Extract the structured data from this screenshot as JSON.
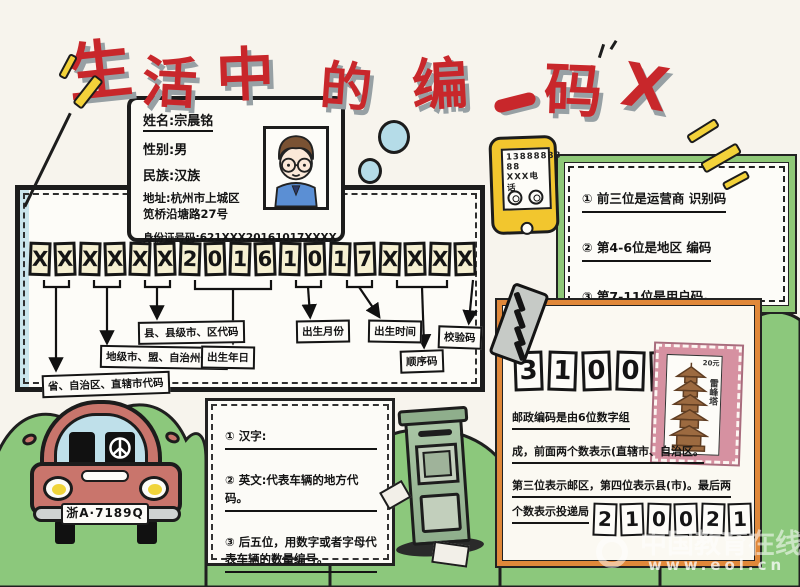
{
  "title": {
    "chars": [
      "生",
      "活",
      "中",
      "的",
      "编",
      "码"
    ],
    "cross": "X"
  },
  "id_card": {
    "name": "姓名:宗晨铭",
    "gender": "性别:男",
    "ethnic": "民族:汉族",
    "address1": "地址:杭州市上城区",
    "address2": "笕桥沿塘路27号",
    "id_number": "身份证号码:621XXX20161017XXXX"
  },
  "id_panel": {
    "digits": [
      "X",
      "X",
      "X",
      "X",
      "X",
      "X",
      "2",
      "0",
      "1",
      "6",
      "1",
      "0",
      "1",
      "7",
      "X",
      "X",
      "X",
      "X"
    ],
    "labels": [
      "省、自治区、直辖市代码",
      "地级市、盟、自治州代码",
      "县、县级市、区代码",
      "出生年日",
      "出生月份",
      "出生时间",
      "顺序码",
      "校验码"
    ]
  },
  "phone": {
    "line1": "13888888",
    "line2": "88",
    "line3": "XXX电话"
  },
  "mobile_box": {
    "items": [
      "① 前三位是运营商 识别码",
      "② 第4-6位是地区 编码",
      "③ 第7-11位是用户码。"
    ]
  },
  "postal_box": {
    "code_top": [
      "3",
      "1",
      "0",
      "0",
      "0",
      "0"
    ],
    "stamp": {
      "price": "20元",
      "name": "雷峰塔"
    },
    "lines": [
      "邮政编码是由6位数字组",
      "成，前面两个数表示(直辖市、自治区。",
      "第三位表示邮区，第四位表示县(市)。最后两",
      "个数表示投递局"
    ],
    "code_bottom": [
      "2",
      "1",
      "0",
      "0",
      "2",
      "1"
    ]
  },
  "plate_box": {
    "items": [
      "① 汉字:",
      "② 英文:代表车辆的地方代码。",
      "③ 后五位，用数字或者字母代表车辆的数量编号。"
    ]
  },
  "car": {
    "plate": "浙A·7189Q"
  },
  "watermark": {
    "site": "中国教育在线",
    "url": "www.eol.cn"
  },
  "colors": {
    "title_red": "#c8272b",
    "shadow_gray": "#97a0a4",
    "sparkle_yellow": "#f3d23a",
    "grass_green": "#8cc87c",
    "green_border": "#8fc878",
    "orange_border": "#e0883a",
    "stamp_pink": "#d691a1",
    "phone_yellow": "#f2c62e",
    "car_red": "#c9756c",
    "bubble_blue": "#b5dce8"
  }
}
